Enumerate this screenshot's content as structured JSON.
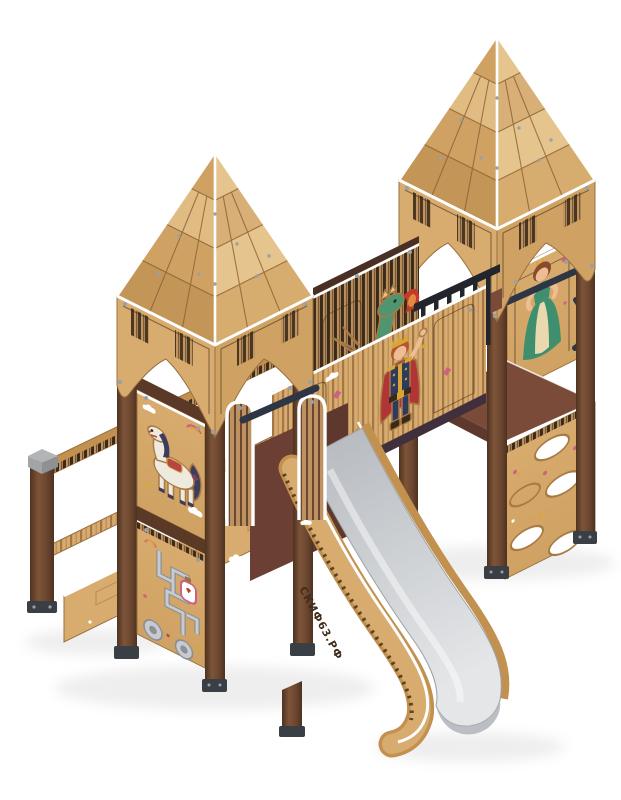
{
  "image": {
    "type": "product-render",
    "subject": "Children's wooden castle playground complex with two shingled towers, stairs and a metal slide",
    "background": "#ffffff"
  },
  "branding": {
    "slide_text": "СКИФ63.РФ"
  },
  "elements": [
    "left-tower",
    "right-tower",
    "tower-roof",
    "roof-fascia",
    "support-post",
    "stair-post",
    "stair-handrail",
    "stair-stringer",
    "deck-back-wall",
    "dragon-decal",
    "king-decal",
    "princess-decal",
    "horse-decal",
    "maze-play-panel",
    "climbing-hole-panel",
    "guard-railing",
    "grab-bar",
    "slide",
    "slide-side-board",
    "slide-entrance-guard",
    "ground-shadow"
  ],
  "colors": {
    "background": "#ffffff",
    "post-dark": "#4e3220",
    "post-mid": "#6b4630",
    "post-light": "#7e5438",
    "wood-light": "#d8ab6e",
    "wood-mid": "#c2914f",
    "wood-deep": "#9a7040",
    "shingle-light": "#e6c48e",
    "shingle-mid": "#cfa263",
    "shingle-dark": "#b98a4e",
    "stripe-light": "#bd9260",
    "stripe-dark": "#3c2a18",
    "trim-white": "#ffffff",
    "outline-tan": "#a87a44",
    "slide-top": "#b4b8bd",
    "slide-bottom": "#e4e6e8",
    "slide-edge": "#9ea3a8",
    "floor-maroon": "#7b4b3a",
    "wall-maroon": "#6b3f33",
    "rail-black": "#22262c",
    "steel-blue": "#2e3646",
    "bolt-gray": "#9aa0a6",
    "cap-gray": "#b2b4b6",
    "dragon-green": "#4f9571",
    "dragon-belly": "#a5cdb4",
    "wing-purple": "#7c4063",
    "fire-red": "#c23c2c",
    "fire-orange": "#e6893f",
    "king-navy": "#2e3a5e",
    "cape-red": "#b23434",
    "gold": "#d9a636",
    "skin": "#eebd93",
    "hair-red": "#b5562e",
    "princess-green": "#3f8f6e",
    "skirt-cream": "#ead9ae",
    "hair-brown": "#8a4a2e",
    "horse-white": "#efeae0",
    "mane-navy": "#3c3c5e",
    "saddle-red": "#b84444",
    "maze-silver": "#c7cbd0",
    "maze-casing": "#8a8f94",
    "shadow": "#8a8a8a",
    "text-brown": "#3f2d1a",
    "pink": "#d06080",
    "leaf-green": "#5e9a52"
  }
}
